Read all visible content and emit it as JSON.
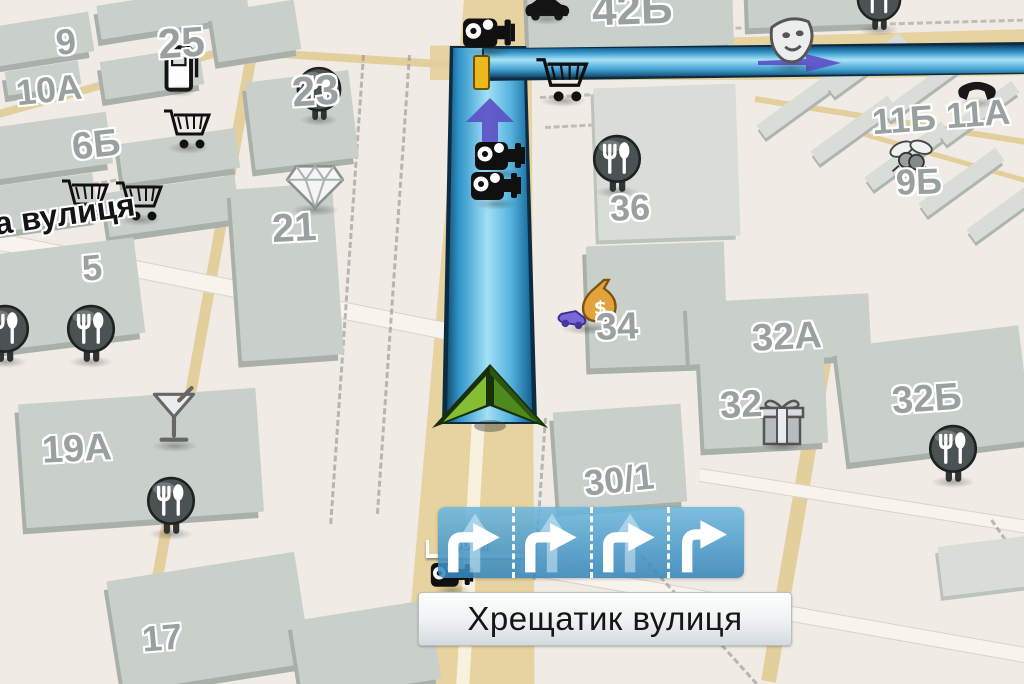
{
  "street_panel": {
    "name": "Хрещатик вулиця"
  },
  "left_street_label": {
    "text": "а вулиця"
  },
  "scale_bar": {
    "label": "50 м"
  },
  "lane_panel": {
    "lanes": [
      {
        "arrows": [
          "straight-faded",
          "right-turn"
        ]
      },
      {
        "arrows": [
          "straight-faded",
          "right-turn"
        ]
      },
      {
        "arrows": [
          "straight-faded",
          "right-turn"
        ]
      },
      {
        "arrows": [
          "right-turn-only"
        ]
      }
    ]
  },
  "building_labels": [
    {
      "text": "9",
      "x": 56,
      "y": 24,
      "size": 36,
      "rot": -6
    },
    {
      "text": "10A",
      "x": 16,
      "y": 72,
      "size": 36,
      "rot": -6
    },
    {
      "text": "25",
      "x": 158,
      "y": 22,
      "size": 42,
      "rot": -4
    },
    {
      "text": "6Б",
      "x": 72,
      "y": 126,
      "size": 38,
      "rot": -6
    },
    {
      "text": "23",
      "x": 292,
      "y": 70,
      "size": 42,
      "rot": -4
    },
    {
      "text": "21",
      "x": 272,
      "y": 208,
      "size": 40,
      "rot": -3
    },
    {
      "text": "5",
      "x": 82,
      "y": 250,
      "size": 36,
      "rot": -5
    },
    {
      "text": "19A",
      "x": 42,
      "y": 430,
      "size": 38,
      "rot": -3
    },
    {
      "text": "17",
      "x": 142,
      "y": 620,
      "size": 36,
      "rot": -5
    },
    {
      "text": "42Б",
      "x": 592,
      "y": -12,
      "size": 44,
      "rot": -2
    },
    {
      "text": "36",
      "x": 610,
      "y": 190,
      "size": 36,
      "rot": -2
    },
    {
      "text": "34",
      "x": 596,
      "y": 308,
      "size": 38,
      "rot": -2
    },
    {
      "text": "30/1",
      "x": 584,
      "y": 462,
      "size": 36,
      "rot": -6
    },
    {
      "text": "32A",
      "x": 752,
      "y": 318,
      "size": 38,
      "rot": -3
    },
    {
      "text": "32",
      "x": 720,
      "y": 386,
      "size": 38,
      "rot": -3
    },
    {
      "text": "32Б",
      "x": 892,
      "y": 380,
      "size": 38,
      "rot": -4
    },
    {
      "text": "11Б",
      "x": 872,
      "y": 102,
      "size": 36,
      "rot": -4
    },
    {
      "text": "11A",
      "x": 946,
      "y": 96,
      "size": 36,
      "rot": -4
    },
    {
      "text": "9Б",
      "x": 896,
      "y": 164,
      "size": 36,
      "rot": -2
    }
  ],
  "map_blocks": [
    {
      "x": -18,
      "y": 20,
      "w": 110,
      "h": 40,
      "rot": -9
    },
    {
      "x": 98,
      "y": -6,
      "w": 150,
      "h": 34,
      "rot": -9
    },
    {
      "x": 6,
      "y": 66,
      "w": 74,
      "h": 24,
      "rot": -9
    },
    {
      "x": 102,
      "y": 54,
      "w": 100,
      "h": 38,
      "rot": -9
    },
    {
      "x": 214,
      "y": 6,
      "w": 84,
      "h": 50,
      "rot": -9
    },
    {
      "x": 250,
      "y": 76,
      "w": 104,
      "h": 88,
      "rot": -7
    },
    {
      "x": -12,
      "y": 120,
      "w": 122,
      "h": 52,
      "rot": -8
    },
    {
      "x": 120,
      "y": 136,
      "w": 118,
      "h": 40,
      "rot": -8
    },
    {
      "x": -12,
      "y": 180,
      "w": 108,
      "h": 46,
      "rot": -8
    },
    {
      "x": 106,
      "y": 184,
      "w": 132,
      "h": 44,
      "rot": -8
    },
    {
      "x": 236,
      "y": 186,
      "w": 102,
      "h": 172,
      "rot": -4
    },
    {
      "x": -8,
      "y": 246,
      "w": 148,
      "h": 96,
      "rot": -7
    },
    {
      "x": 22,
      "y": 396,
      "w": 238,
      "h": 124,
      "rot": -4
    },
    {
      "x": 114,
      "y": 566,
      "w": 190,
      "h": 112,
      "rot": -9
    },
    {
      "x": 296,
      "y": 610,
      "w": 140,
      "h": 80,
      "rot": -9
    },
    {
      "x": 528,
      "y": -14,
      "w": 205,
      "h": 62,
      "rot": -2
    },
    {
      "x": 748,
      "y": -16,
      "w": 130,
      "h": 42,
      "rot": -2
    },
    {
      "x": 596,
      "y": 86,
      "w": 142,
      "h": 152,
      "rot": -2,
      "tone": "light"
    },
    {
      "x": 588,
      "y": 244,
      "w": 138,
      "h": 122,
      "rot": -2
    },
    {
      "x": 556,
      "y": 408,
      "w": 128,
      "h": 98,
      "rot": -4
    },
    {
      "x": 688,
      "y": 298,
      "w": 182,
      "h": 62,
      "rot": -3
    },
    {
      "x": 702,
      "y": 358,
      "w": 124,
      "h": 88,
      "rot": -3
    },
    {
      "x": 842,
      "y": 336,
      "w": 184,
      "h": 116,
      "rot": -7
    },
    {
      "x": 752,
      "y": 96,
      "w": 95,
      "h": 16,
      "rot": -36,
      "tone": "light",
      "slab": true
    },
    {
      "x": 806,
      "y": 122,
      "w": 95,
      "h": 16,
      "rot": -36,
      "tone": "light",
      "slab": true
    },
    {
      "x": 860,
      "y": 148,
      "w": 95,
      "h": 16,
      "rot": -36,
      "tone": "light",
      "slab": true
    },
    {
      "x": 914,
      "y": 174,
      "w": 95,
      "h": 16,
      "rot": -36,
      "tone": "light",
      "slab": true
    },
    {
      "x": 962,
      "y": 200,
      "w": 95,
      "h": 16,
      "rot": -36,
      "tone": "light",
      "slab": true
    },
    {
      "x": 822,
      "y": 58,
      "w": 90,
      "h": 14,
      "rot": -36,
      "tone": "light",
      "slab": true
    },
    {
      "x": 878,
      "y": 82,
      "w": 90,
      "h": 14,
      "rot": -36,
      "tone": "light",
      "slab": true
    },
    {
      "x": 934,
      "y": 106,
      "w": 90,
      "h": 14,
      "rot": -36,
      "tone": "light",
      "slab": true
    },
    {
      "x": 940,
      "y": 540,
      "w": 110,
      "h": 50,
      "rot": -7,
      "tone": "light"
    }
  ],
  "pois": [
    {
      "type": "speed-camera",
      "x": 462,
      "y": 10,
      "s": 54
    },
    {
      "type": "speed-camera",
      "x": 474,
      "y": 134,
      "s": 52
    },
    {
      "type": "speed-camera",
      "x": 470,
      "y": 164,
      "s": 52
    },
    {
      "type": "speed-camera",
      "x": 430,
      "y": 556,
      "s": 44,
      "under": true
    },
    {
      "type": "shopping-cart",
      "x": 534,
      "y": 52,
      "s": 58
    },
    {
      "type": "shopping-cart",
      "x": 162,
      "y": 104,
      "s": 52
    },
    {
      "type": "shopping-cart",
      "x": 60,
      "y": 174,
      "s": 52
    },
    {
      "type": "shopping-cart",
      "x": 114,
      "y": 176,
      "s": 52
    },
    {
      "type": "restaurant",
      "x": 294,
      "y": 66,
      "s": 50
    },
    {
      "type": "restaurant",
      "x": 590,
      "y": 134,
      "s": 54
    },
    {
      "type": "restaurant",
      "x": 64,
      "y": 304,
      "s": 54
    },
    {
      "type": "restaurant",
      "x": -22,
      "y": 304,
      "s": 54
    },
    {
      "type": "restaurant",
      "x": 144,
      "y": 476,
      "s": 54
    },
    {
      "type": "restaurant",
      "x": 926,
      "y": 424,
      "s": 54
    },
    {
      "type": "restaurant",
      "x": 854,
      "y": -24,
      "s": 50
    },
    {
      "type": "martini",
      "x": 146,
      "y": 386,
      "s": 58
    },
    {
      "type": "diamond",
      "x": 284,
      "y": 162,
      "s": 62
    },
    {
      "type": "gift",
      "x": 756,
      "y": 396,
      "s": 52
    },
    {
      "type": "money-exchange",
      "x": 554,
      "y": 278,
      "s": 68
    },
    {
      "type": "theater-masks",
      "x": 762,
      "y": 12,
      "s": 58
    },
    {
      "type": "telephone",
      "x": 956,
      "y": 76,
      "s": 42
    },
    {
      "type": "insect",
      "x": 886,
      "y": 136,
      "s": 48
    },
    {
      "type": "car",
      "x": 522,
      "y": -6,
      "s": 50
    },
    {
      "type": "fuel",
      "x": 162,
      "y": 44,
      "s": 38
    }
  ],
  "colors": {
    "route_blue": "#3fa0d4",
    "route_outline": "#0c2c44",
    "direction_arrow_purple": "#5c4ec4",
    "lane_panel_blue": "#4a9fce",
    "road_yellow": "#e7d3a0",
    "building_gray": "#c9cfc9",
    "position_arrow_green": "#7ab32e",
    "background": "#f0ebe4",
    "maneuver_marker_yellow": "#ecb81e"
  }
}
